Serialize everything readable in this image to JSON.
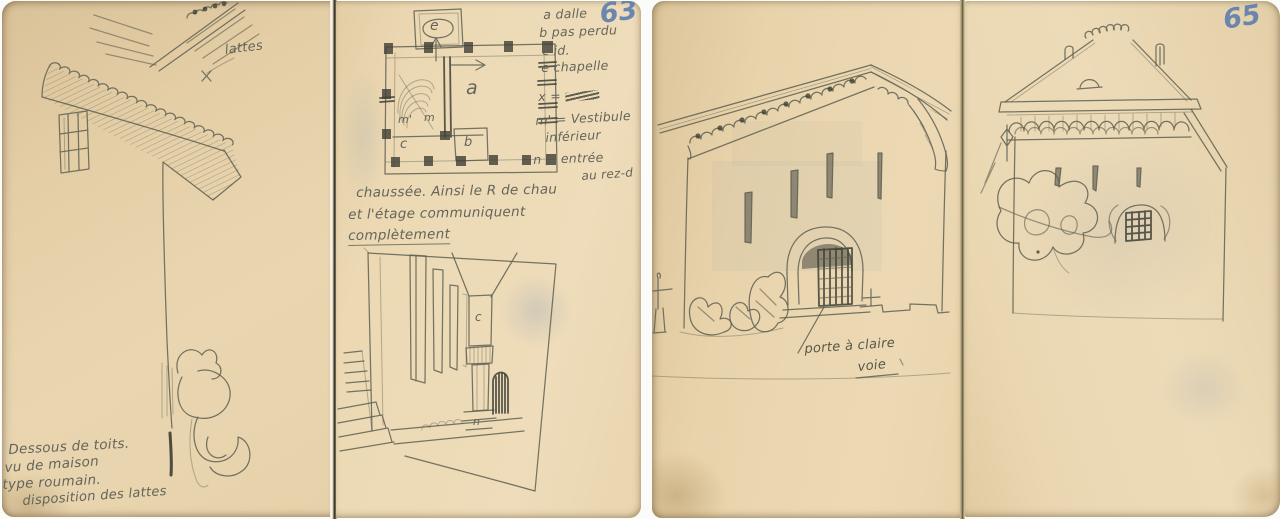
{
  "colors": {
    "paper": "#e9d5ae",
    "pencil": "#5f6052",
    "blue_pencil": "#5d7eb0",
    "dark_pencil": "#3f4037"
  },
  "left_spread": {
    "page_number": "63",
    "page1": {
      "lattes_label": "lattes",
      "caption": [
        "Dessous de toits.",
        "vu de maison",
        "type roumain.",
        "disposition des lattes"
      ]
    },
    "page2": {
      "plan_labels": {
        "e": "e",
        "a": "a",
        "m_prime": "m'",
        "m": "m",
        "c": "c",
        "b": "b"
      },
      "legend": [
        {
          "text": "a dalle"
        },
        {
          "text": "b pas perdu"
        },
        {
          "text": "c id."
        },
        {
          "text": "e chapelle"
        },
        {
          "text": "x ="
        },
        {
          "text": "m' = Vestibule"
        },
        {
          "text": "inférieur"
        },
        {
          "text": "n = entrée"
        },
        {
          "text": "au rez-d"
        }
      ],
      "paragraph": [
        "chaussée. Ainsi le R de chau",
        "et l'étage communiquent",
        "complètement"
      ],
      "corridor_labels": {
        "c": "c",
        "n": "n"
      }
    }
  },
  "right_spread": {
    "page_number": "65",
    "page3": {
      "caption": [
        "porte à claire",
        "voie"
      ]
    },
    "page4": {}
  }
}
